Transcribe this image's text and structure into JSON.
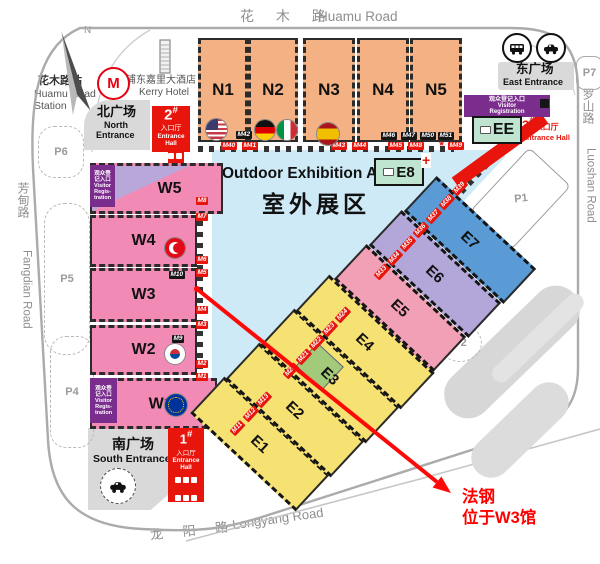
{
  "compass": {
    "label": "N"
  },
  "roads": {
    "top_cn": "花 木 路",
    "top_en": "Huamu Road",
    "right_cn": "罗山路",
    "right_en": "Luoshan Road",
    "left_cn": "芳甸路",
    "left_en": "Fangdian Road",
    "bottom_cn": "龙 阳 路",
    "bottom_en": "Longyang Road"
  },
  "station": {
    "cn": "花木路站",
    "en1": "Huamu Road",
    "en2": "Station"
  },
  "hotel": {
    "cn": "浦东嘉里大酒店",
    "en": "Kerry Hotel"
  },
  "plazas": {
    "north": {
      "cn": "北广场",
      "en1": "North",
      "en2": "Entrance"
    },
    "south": {
      "cn": "南广场",
      "en": "South Entrance"
    },
    "east": {
      "cn": "东广场",
      "en": "East Entrance"
    }
  },
  "entrance_halls": {
    "h1": {
      "num": "1",
      "mark": "#",
      "cn": "入口厅",
      "en1": "Entrance",
      "en2": "Hall"
    },
    "h2": {
      "num": "2",
      "mark": "#",
      "cn": "入口厅",
      "en": "Entrance Hall"
    },
    "h3": {
      "num": "3",
      "mark": "#",
      "cn": "入口厅",
      "en": "Entrance Hall"
    }
  },
  "registration": {
    "west": {
      "l1": "观众登",
      "l2": "记入口",
      "l3": "Visitor",
      "l4": "Regis-",
      "l5": "tration"
    },
    "east": {
      "l1": "观众登记入口",
      "l2": "Visitor",
      "l3": "Registration"
    }
  },
  "outdoor": {
    "en": "Outdoor Exhibition Area",
    "cn": "室外展区"
  },
  "halls": {
    "n1": "N1",
    "n2": "N2",
    "n3": "N3",
    "n4": "N4",
    "n5": "N5",
    "w1": "W1",
    "w1_sup": "b",
    "w2": "W2",
    "w3": "W3",
    "w4": "W4",
    "w5": "W5",
    "e1": "E1",
    "e2": "E2",
    "e3": "E3",
    "e4": "E4",
    "e5": "E5",
    "e6": "E6",
    "e7": "E7",
    "e8": "E8",
    "ee": "EE"
  },
  "parking": {
    "p1": "P1",
    "p2": "P2",
    "p3": "P3",
    "p4": "P4",
    "p5": "P5",
    "p6": "P6",
    "p7": "P7"
  },
  "gates": {
    "north_black": [
      "M42",
      "M46",
      "M47",
      "M50",
      "M51"
    ],
    "north_red": [
      "M40",
      "M41",
      "M43",
      "M44",
      "M45",
      "M48",
      "M49"
    ],
    "west_red": [
      "M8",
      "M7",
      "M6",
      "M5",
      "M4",
      "M3",
      "M2",
      "M1"
    ],
    "inner_black": [
      "M10",
      "M9"
    ],
    "diag_red": [
      "M11",
      "M12",
      "M13",
      "M20",
      "M21",
      "M22",
      "M23",
      "M24",
      "M33",
      "M34",
      "M35",
      "M36",
      "M37",
      "M38",
      "M39"
    ]
  },
  "glyphs": {
    "star": "★",
    "cross": "+"
  },
  "icons": [
    "north-arrow",
    "metro-logo",
    "hotel-building",
    "bus",
    "car",
    "taxi",
    "first-aid-cross",
    "us-flag",
    "germany-flag",
    "italy-flag",
    "spain-flag",
    "turkey-flag",
    "south-korea-flag",
    "eu-flag",
    "camera"
  ],
  "annotation": {
    "l1": "法钢",
    "l2": "位于W3馆"
  },
  "colors": {
    "hall_north": "#F4B183",
    "hall_west": "#F28AB6",
    "hall_east_yellow": "#F6E173",
    "hall_e5": "#F2A0B5",
    "hall_e6": "#B3A6D9",
    "hall_e7": "#5B9BD5",
    "teal": "#BFE5D1",
    "outdoor_blue": "#CDEAF6",
    "entrance_red": "#E8150D",
    "registration_purple": "#7B2D8E",
    "plaza_gray": "#D9D9D9",
    "green_block": "#A3C97B",
    "annotation_red": "#FF0000"
  }
}
